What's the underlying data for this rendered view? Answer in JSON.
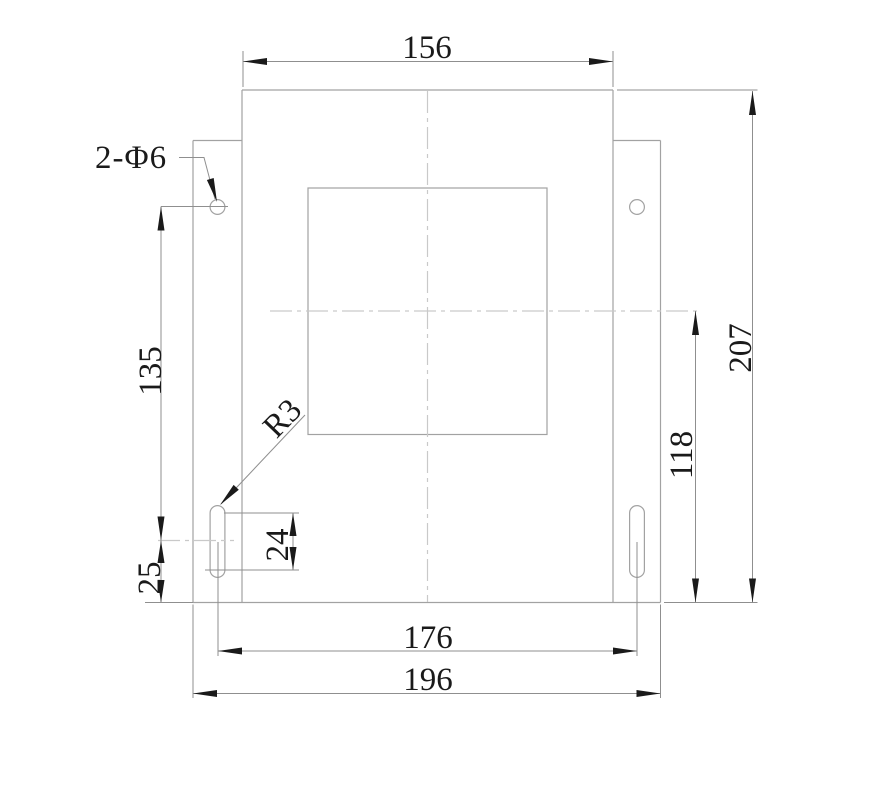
{
  "drawing": {
    "labels": {
      "width_top": "156",
      "height_overall": "207",
      "center_to_bottom": "118",
      "hole_to_slot": "135",
      "slot_to_bottom": "25",
      "slot_length": "24",
      "holes_spacing": "176",
      "width_overall": "196",
      "holes_callout": "2-Φ6",
      "corner_radius": "R3"
    },
    "colors": {
      "outline": "#a2a2a2",
      "dimension": "#8f8f8f",
      "centerline": "#c9c9c9",
      "ink": "#1a1a1a",
      "background": "#ffffff"
    }
  }
}
